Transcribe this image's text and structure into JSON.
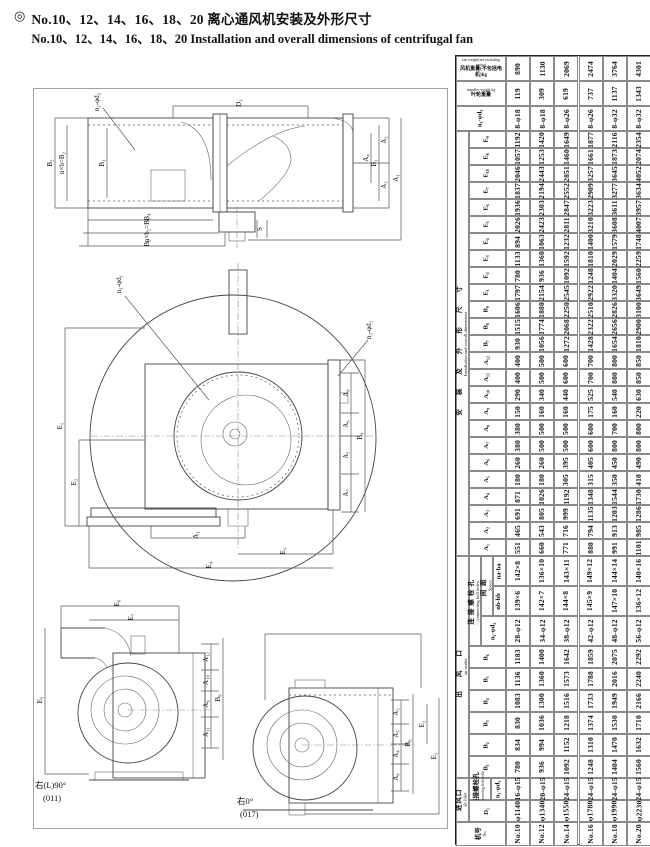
{
  "title": {
    "bullet": "◎",
    "line1_cn": "No.10、12、14、16、18、20 离心通风机安装及外形尺寸",
    "line2_en": "No.10、12、14、16、18、20 Installation and overall dimensions of centrifugal fan"
  },
  "table": {
    "fans": [
      "No.10",
      "No.12",
      "No.14",
      "No.16",
      "No.18",
      "No.20"
    ],
    "groups": [
      {
        "id": "install",
        "cn": "安装及外形尺寸",
        "en": "Installation and overall dimensions",
        "x": 0,
        "w": 13,
        "start": 3,
        "end": 27,
        "ls": 14
      },
      {
        "id": "outlet",
        "cn": "出风口",
        "en": "air outlet",
        "x": 0,
        "w": 13,
        "start": 28,
        "end": 36,
        "ls": 14
      },
      {
        "id": "inlet",
        "cn": "进风口",
        "en": "air inlet",
        "x": 0,
        "w": 13,
        "start": 37,
        "end": 38,
        "ls": 1
      },
      {
        "id": "bolt-holes",
        "cn": "连接螺栓孔",
        "en": "connecting bolt holes",
        "x": 13,
        "w": 12,
        "start": 28,
        "end": 30,
        "ls": 3
      },
      {
        "id": "space",
        "cn": "间距",
        "en": "Space",
        "x": 25,
        "w": 12,
        "start": 28,
        "end": 29,
        "ls": 4
      }
    ],
    "bands": [
      {
        "id": "fan-weight",
        "h": 25,
        "labels": [
          {
            "x": 0,
            "w": 50,
            "cn": "风机重量(不包括电机)kg",
            "en": "fan weight(not including motor)",
            "horiz": true
          }
        ],
        "values": [
          "890",
          "1130",
          "2069",
          "2474",
          "3764",
          "4301"
        ]
      },
      {
        "id": "impeller-weight",
        "h": 25,
        "labels": [
          {
            "x": 0,
            "w": 50,
            "cn": "叶轮重量",
            "en": "impeller weight kg",
            "horiz": true
          }
        ],
        "values": [
          "119",
          "309",
          "619",
          "737",
          "1137",
          "1343"
        ]
      },
      {
        "id": "n3-d3",
        "h": 25,
        "labels": [
          {
            "x": 0,
            "w": 50,
            "cn": "n₃-φd₃"
          }
        ],
        "values": [
          "8-φ18",
          "8-φ18",
          "8-φ26",
          "8-φ26",
          "8-φ32",
          "8-φ32"
        ]
      },
      {
        "id": "E9",
        "h": 17,
        "labels": [
          {
            "x": 13,
            "w": 37,
            "cn": "E₉"
          }
        ],
        "values": [
          "1192",
          "1420",
          "1649",
          "1877",
          "2116",
          "2354"
        ]
      },
      {
        "id": "E8",
        "h": 17,
        "labels": [
          {
            "x": 13,
            "w": 37,
            "cn": "E₈"
          }
        ],
        "values": [
          "1057",
          "1253",
          "1460",
          "1661",
          "1873",
          "2074"
        ]
      },
      {
        "id": "E10",
        "h": 17,
        "labels": [
          {
            "x": 13,
            "w": 37,
            "cn": "E₁₀"
          }
        ],
        "values": [
          "2046",
          "2443",
          "2851",
          "3257",
          "3645",
          "4052"
        ]
      },
      {
        "id": "E7",
        "h": 17,
        "labels": [
          {
            "x": 13,
            "w": 37,
            "cn": "E₇"
          }
        ],
        "values": [
          "1837",
          "2194",
          "2552",
          "2909",
          "3277",
          "3634"
        ]
      },
      {
        "id": "E6",
        "h": 17,
        "labels": [
          {
            "x": 13,
            "w": 37,
            "cn": "E₆"
          }
        ],
        "values": [
          "1936",
          "2303",
          "2847",
          "3223",
          "3611",
          "3957"
        ]
      },
      {
        "id": "E5",
        "h": 17,
        "labels": [
          {
            "x": 13,
            "w": 37,
            "cn": "E₅"
          }
        ],
        "values": [
          "2026",
          "2423",
          "2811",
          "3210",
          "3608",
          "4007"
        ]
      },
      {
        "id": "E4",
        "h": 17,
        "labels": [
          {
            "x": 13,
            "w": 37,
            "cn": "E₄"
          }
        ],
        "values": [
          "894",
          "1063",
          "1232",
          "1400",
          "1579",
          "1748"
        ]
      },
      {
        "id": "E3",
        "h": 17,
        "labels": [
          {
            "x": 13,
            "w": 37,
            "cn": "E₃"
          }
        ],
        "values": [
          "1133",
          "1360",
          "1592",
          "1810",
          "2029",
          "2259"
        ]
      },
      {
        "id": "E2",
        "h": 17,
        "labels": [
          {
            "x": 13,
            "w": 37,
            "cn": "E₂"
          }
        ],
        "values": [
          "780",
          "936",
          "1092",
          "1248",
          "1404",
          "1560"
        ]
      },
      {
        "id": "E1",
        "h": 17,
        "labels": [
          {
            "x": 13,
            "w": 37,
            "cn": "E₁"
          }
        ],
        "values": [
          "1797",
          "2154",
          "2545",
          "2922",
          "3320",
          "3649"
        ]
      },
      {
        "id": "B9",
        "h": 17,
        "labels": [
          {
            "x": 13,
            "w": 37,
            "cn": "B₉"
          }
        ],
        "values": [
          "1606",
          "1880",
          "2250",
          "2510",
          "2826",
          "3100"
        ]
      },
      {
        "id": "B8",
        "h": 17,
        "labels": [
          {
            "x": 13,
            "w": 37,
            "cn": "B₈"
          }
        ],
        "values": [
          "1515",
          "1774",
          "2068",
          "2322",
          "2656",
          "2900"
        ]
      },
      {
        "id": "B7",
        "h": 17,
        "labels": [
          {
            "x": 13,
            "w": 37,
            "cn": "B₇"
          }
        ],
        "values": [
          "930",
          "1056",
          "1272",
          "1428",
          "1654",
          "1810"
        ]
      },
      {
        "id": "A12",
        "h": 17,
        "labels": [
          {
            "x": 13,
            "w": 37,
            "cn": "A₁₂"
          }
        ],
        "values": [
          "400",
          "500",
          "600",
          "700",
          "800",
          "850"
        ]
      },
      {
        "id": "A11",
        "h": 17,
        "labels": [
          {
            "x": 13,
            "w": 37,
            "cn": "A₁₁"
          }
        ],
        "values": [
          "400",
          "500",
          "600",
          "700",
          "800",
          "850"
        ]
      },
      {
        "id": "A10",
        "h": 17,
        "labels": [
          {
            "x": 13,
            "w": 37,
            "cn": "A₁₀"
          }
        ],
        "values": [
          "290",
          "340",
          "440",
          "525",
          "540",
          "630"
        ]
      },
      {
        "id": "A9",
        "h": 17,
        "labels": [
          {
            "x": 13,
            "w": 37,
            "cn": "A₉"
          }
        ],
        "values": [
          "150",
          "160",
          "160",
          "175",
          "160",
          "220"
        ]
      },
      {
        "id": "A8",
        "h": 17,
        "labels": [
          {
            "x": 13,
            "w": 37,
            "cn": "A₈"
          }
        ],
        "values": [
          "380",
          "500",
          "500",
          "600",
          "700",
          "800"
        ]
      },
      {
        "id": "A7",
        "h": 17,
        "labels": [
          {
            "x": 13,
            "w": 37,
            "cn": "A₇"
          }
        ],
        "values": [
          "380",
          "500",
          "500",
          "600",
          "800",
          "800"
        ]
      },
      {
        "id": "A6",
        "h": 17,
        "labels": [
          {
            "x": 13,
            "w": 37,
            "cn": "A₆"
          }
        ],
        "values": [
          "260",
          "260",
          "395",
          "405",
          "450",
          "490"
        ]
      },
      {
        "id": "A5",
        "h": 17,
        "labels": [
          {
            "x": 13,
            "w": 37,
            "cn": "A₅"
          }
        ],
        "values": [
          "180",
          "180",
          "305",
          "315",
          "350",
          "410"
        ]
      },
      {
        "id": "A4",
        "h": 17,
        "labels": [
          {
            "x": 13,
            "w": 37,
            "cn": "A₄"
          }
        ],
        "values": [
          "871",
          "1026",
          "1192",
          "1348",
          "1544",
          "1730"
        ]
      },
      {
        "id": "A3",
        "h": 17,
        "labels": [
          {
            "x": 13,
            "w": 37,
            "cn": "A₃"
          }
        ],
        "values": [
          "691",
          "805",
          "999",
          "1135",
          "1203",
          "1286"
        ]
      },
      {
        "id": "A2",
        "h": 17,
        "labels": [
          {
            "x": 13,
            "w": 37,
            "cn": "A₂"
          }
        ],
        "values": [
          "465",
          "543",
          "716",
          "794",
          "913",
          "985"
        ]
      },
      {
        "id": "A1",
        "h": 17,
        "labels": [
          {
            "x": 13,
            "w": 37,
            "cn": "A₁"
          }
        ],
        "values": [
          "551",
          "660",
          "771",
          "880",
          "991",
          "1101"
        ]
      },
      {
        "id": "space-na",
        "h": 30,
        "labels": [
          {
            "x": 37,
            "w": 13,
            "cn": "na-ba"
          }
        ],
        "values": [
          "142×8",
          "136×10",
          "143×11",
          "149×12",
          "144×14",
          "140×16"
        ]
      },
      {
        "id": "space-nb",
        "h": 30,
        "labels": [
          {
            "x": 37,
            "w": 13,
            "cn": "nb-bb"
          }
        ],
        "values": [
          "139×6",
          "142×7",
          "144×8",
          "145×9",
          "147×10",
          "136×12"
        ]
      },
      {
        "id": "n2-d2",
        "h": 30,
        "labels": [
          {
            "x": 25,
            "w": 25,
            "cn": "n₂-φd₂"
          }
        ],
        "values": [
          "28-φ12",
          "34-φ12",
          "38-φ12",
          "42-φ12",
          "48-φ12",
          "56-φ12"
        ]
      },
      {
        "id": "B6",
        "h": 22,
        "labels": [
          {
            "x": 13,
            "w": 37,
            "cn": "B₆"
          }
        ],
        "values": [
          "1183",
          "1400",
          "1642",
          "1859",
          "2075",
          "2292"
        ]
      },
      {
        "id": "B5",
        "h": 22,
        "labels": [
          {
            "x": 13,
            "w": 37,
            "cn": "B₅"
          }
        ],
        "values": [
          "1136",
          "1360",
          "1573",
          "1788",
          "2016",
          "2240"
        ]
      },
      {
        "id": "B4",
        "h": 22,
        "labels": [
          {
            "x": 13,
            "w": 37,
            "cn": "B₄"
          }
        ],
        "values": [
          "1083",
          "1300",
          "1516",
          "1733",
          "1949",
          "2166"
        ]
      },
      {
        "id": "B3",
        "h": 22,
        "labels": [
          {
            "x": 13,
            "w": 37,
            "cn": "B₃"
          }
        ],
        "values": [
          "830",
          "1036",
          "1218",
          "1374",
          "1530",
          "1710"
        ]
      },
      {
        "id": "B2",
        "h": 22,
        "labels": [
          {
            "x": 13,
            "w": 37,
            "cn": "B₂"
          }
        ],
        "values": [
          "834",
          "994",
          "1152",
          "1310",
          "1470",
          "1632"
        ]
      },
      {
        "id": "B1",
        "h": 22,
        "labels": [
          {
            "x": 13,
            "w": 37,
            "cn": "B₁"
          }
        ],
        "values": [
          "780",
          "936",
          "1092",
          "1248",
          "1404",
          "1560"
        ]
      },
      {
        "id": "n1-d1",
        "h": 22,
        "labels": [
          {
            "x": 13,
            "w": 22,
            "cn": "连接螺栓孔",
            "en": "Connecting bolt hole"
          },
          {
            "x": 35,
            "w": 15,
            "cn": "n₁-φd₁"
          }
        ],
        "values": [
          "16-φ15",
          "20-φ15",
          "24-φ15",
          "24-φ15",
          "24-φ15",
          "24-φ15"
        ]
      },
      {
        "id": "D1",
        "h": 22,
        "labels": [
          {
            "x": 13,
            "w": 37,
            "cn": "D₁"
          }
        ],
        "values": [
          "φ1140",
          "φ1340",
          "φ1550",
          "φ1780",
          "φ1990",
          "φ2230"
        ]
      },
      {
        "id": "fan-no",
        "h": 24,
        "labels": [
          {
            "x": 0,
            "w": 50,
            "cn": "机号",
            "en": "No."
          }
        ],
        "values": [
          "No.10",
          "No.12",
          "No.14",
          "No.16",
          "No.18",
          "No.20"
        ]
      }
    ]
  },
  "drawings": {
    "labels": [
      {
        "t": "n₂-φd₂",
        "x": 66,
        "y": 14
      },
      {
        "t": "D₁",
        "x": 208,
        "y": 15
      },
      {
        "t": "B₃",
        "x": 19,
        "y": 75
      },
      {
        "t": "n×b=B₂",
        "x": 31,
        "y": 75
      },
      {
        "t": "B₁",
        "x": 71,
        "y": 75
      },
      {
        "t": "A₄",
        "x": 335,
        "y": 70
      },
      {
        "t": "B₁",
        "x": 343,
        "y": 75
      },
      {
        "t": "A₂",
        "x": 353,
        "y": 52
      },
      {
        "t": "A₃",
        "x": 353,
        "y": 97
      },
      {
        "t": "A₁",
        "x": 365,
        "y": 90
      },
      {
        "t": "B₄",
        "x": 116,
        "y": 129
      },
      {
        "t": "n×b₂=B₅",
        "x": 116,
        "y": 142
      },
      {
        "t": "B₆",
        "x": 116,
        "y": 155
      },
      {
        "t": "S",
        "x": 229,
        "y": 141
      },
      {
        "t": "n₁-φd₁",
        "x": 88,
        "y": 196
      },
      {
        "t": "n₃-φd₃",
        "x": 338,
        "y": 242
      },
      {
        "t": "E₁",
        "x": 29,
        "y": 338
      },
      {
        "t": "E₂",
        "x": 43,
        "y": 394
      },
      {
        "t": "A₈",
        "x": 315,
        "y": 305
      },
      {
        "t": "A₆",
        "x": 315,
        "y": 336
      },
      {
        "t": "A₅",
        "x": 315,
        "y": 367
      },
      {
        "t": "A₇",
        "x": 315,
        "y": 405
      },
      {
        "t": "B₈",
        "x": 329,
        "y": 348
      },
      {
        "t": "A₁",
        "x": 165,
        "y": 447
      },
      {
        "t": "E₃",
        "x": 252,
        "y": 463
      },
      {
        "t": "E₄",
        "x": 178,
        "y": 477
      },
      {
        "t": "E₆",
        "x": 86,
        "y": 515
      },
      {
        "t": "E₇",
        "x": 100,
        "y": 529
      },
      {
        "t": "E₅",
        "x": 9,
        "y": 612
      },
      {
        "t": "A₁₂",
        "x": 175,
        "y": 569
      },
      {
        "t": "A₁₀",
        "x": 175,
        "y": 592
      },
      {
        "t": "A₉",
        "x": 175,
        "y": 616
      },
      {
        "t": "A₁₁",
        "x": 175,
        "y": 644
      },
      {
        "t": "B₉",
        "x": 187,
        "y": 610
      },
      {
        "t": "A₃",
        "x": 365,
        "y": 624
      },
      {
        "t": "A₅",
        "x": 365,
        "y": 646
      },
      {
        "t": "A₄",
        "x": 365,
        "y": 666
      },
      {
        "t": "A₈",
        "x": 365,
        "y": 689
      },
      {
        "t": "B₈",
        "x": 377,
        "y": 655
      },
      {
        "t": "E₂",
        "x": 391,
        "y": 636
      },
      {
        "t": "E₁",
        "x": 403,
        "y": 668
      },
      {
        "t": "右(L)90°",
        "x": 2,
        "y": 700,
        "r": 0
      },
      {
        "t": "(011)",
        "x": 10,
        "y": 713,
        "r": 0
      },
      {
        "t": "右0°",
        "x": 204,
        "y": 716,
        "r": 0
      },
      {
        "t": "(017)",
        "x": 207,
        "y": 729,
        "r": 0
      }
    ]
  }
}
